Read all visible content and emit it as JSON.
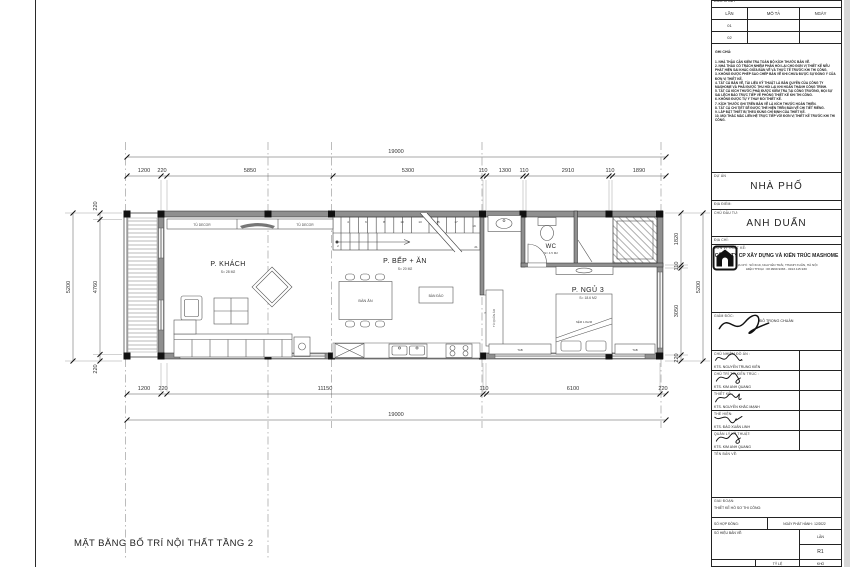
{
  "drawing_title": "MẶT BẰNG BỐ TRÍ NỘI THẤT TẦNG 2",
  "plan": {
    "rooms": {
      "living": {
        "name": "P. KHÁCH",
        "area": "S= 28 M2"
      },
      "kitchen": {
        "name": "P. BẾP + ĂN",
        "area": "S= 20 M2"
      },
      "wc": {
        "name": "WC",
        "area": "S= 4.5 M2"
      },
      "bedroom": {
        "name": "P. NGỦ 3",
        "area": "S= 18.6 M2"
      }
    },
    "furniture": {
      "tu_decor_left": "TỦ DECOR",
      "tu_decor_right": "TỦ DECOR",
      "ban_an": "BÀN ĂN",
      "ban_dao": "BÀN ĐẢO",
      "tu_quan_ao": "TỦ QUẦN ÁO",
      "bed": "NỆM 1.8x2M",
      "tab_left": "TAB",
      "tab_right": "TAB"
    },
    "stairs": {
      "numbers": [
        "2",
        "4",
        "6",
        "8",
        "10",
        "13",
        "15",
        "17",
        "19",
        "21"
      ]
    },
    "dims": {
      "top_overall": "19000",
      "top_segments": [
        "1200",
        "220",
        "5850",
        "5300",
        "110",
        "1300",
        "110",
        "2910",
        "110",
        "1890"
      ],
      "bottom_segments": [
        "1200",
        "220",
        "11150",
        "110",
        "6100",
        "220"
      ],
      "bottom_overall": "19000",
      "left_outer": "5200",
      "left_segments": [
        "220",
        "4760",
        "220"
      ],
      "right_segments": [
        "1820",
        "110",
        "3050",
        "220"
      ],
      "right_outer": "5200"
    }
  },
  "title_block": {
    "revision": {
      "header_label": "ĐIỀU CHỈNH",
      "col_lan": "LẦN",
      "col_mo_ta": "MÔ TẢ",
      "col_ngay": "NGÀY",
      "row1": "01",
      "row2": "02"
    },
    "notes_title": "GHI CHÚ:",
    "notes_text": "1. NHÀ THẦU CẦN KIỂM TRA TOÀN BỘ KÍCH THƯỚC BẢN VẼ.\n2. NHÀ THẦU CÓ TRÁCH NHIỆM PHẢN HỒI LẠI CHO ĐƠN VỊ THIẾT KẾ NẾU PHÁT HIỆN SAI KHÁC GIỮA BẢN VẼ VÀ THỰC TẾ TRƯỚC KHI THI CÔNG.\n3. KHÔNG ĐƯỢC PHÉP SAO CHÉP BẢN VẼ KHI CHƯA ĐƯỢC SỰ ĐỒNG Ý CỦA ĐƠN VỊ THIẾT KẾ.\n4. TẤT CẢ BẢN VẼ, TÀI LIỆU KỸ THUẬT LÀ BẢN QUYỀN CỦA CÔNG TY MASHOME VÀ PHẢI ĐƯỢC THU HỒI LẠI KHI HOÀN THÀNH CÔNG TRÌNH.\n5. TẤT CẢ KÍCH THƯỚC PHẢI ĐƯỢC KIỂM TRA TẠI CÔNG TRƯỜNG, MỌI SỰ SAI LỆCH BÁO TRỰC TIẾP VỀ PHÒNG THIẾT KẾ KHI THI CÔNG.\n6. KHÔNG ĐƯỢC TỰ Ý THAY ĐỔI THIẾT KẾ.\n7. KÍCH THƯỚC GHI TRÊN BẢN VẼ LÀ KÍCH THƯỚC HOÀN THIỆN.\n8. TẤT CẢ CHI TIẾT SẼ ĐƯỢC THỂ HIỆN TRÊN BẢN VẼ CHI TIẾT RIÊNG.\n9. LẮP ĐẶT THIẾT BỊ THEO ĐÚNG CHỈ ĐỊNH CỦA THIẾT KẾ.\n10. MỌI THẮC MẮC LIÊN HỆ TRỰC TIẾP VỚI ĐƠN VỊ THIẾT KẾ TRƯỚC KHI THI CÔNG.",
    "du_an_label": "DỰ ÁN",
    "du_an": "NHÀ PHỐ",
    "dia_diem_label": "ĐỊA ĐIỂM:",
    "chu_dau_tu_label": "CHỦ ĐẦU TƯ:",
    "chu_dau_tu": "ANH DUẤN",
    "dia_chi_label": "ĐỊA CHỈ:",
    "don_vi_label": "ĐƠN VỊ THIẾT KẾ:",
    "company": "CÔNG TY CP XÂY DỰNG VÀ KIẾN TRÚC MASHOME",
    "address_line1": "ĐỊA CHỈ : SỐ 6/19, NGUYỄN TRÃI, THANH XUÂN, HÀ NỘI",
    "address_line2": "ĐIỆN THOẠI : 08.9999.9383 - 0913.115.930",
    "giam_doc_label": "GIÁM ĐỐC:",
    "giam_doc": "ĐỖ TRỌNG CHUẨN",
    "staff": [
      {
        "label": "CHỦ NHIỆM ĐỒ ÁN :",
        "name": "KTS. NGUYỄN TRUNG KIÊN"
      },
      {
        "label": "CHỦ TRÌ T.K KIẾN TRÚC :",
        "name": "KTS. KIM ANH QUANG"
      },
      {
        "label": "THIẾT KẾ :",
        "name": "KTS. NGUYỄN KHẮC MẠNH"
      },
      {
        "label": "THỂ HIỆN:",
        "name": "KTS. ĐÀO XUÂN LINH"
      },
      {
        "label": "QUẢN LÝ KỸ THUẬT:",
        "name": "KTS. KIM ANH QUANG"
      }
    ],
    "ten_ban_ve_label": "TÊN BẢN VẼ:",
    "giai_doan_label": "GIAI ĐOẠN:",
    "giai_doan": "THIẾT KẾ HỒ SƠ THI CÔNG:",
    "so_hop_dong_label": "SỐ HỢP ĐỒNG:",
    "ngay_phat_hanh": "NGÀY PHÁT HÀNH : 12/2022",
    "so_hieu_label": "SỐ HIỆU BẢN VẼ:",
    "lan_label": "LẦN",
    "lan_value": "R1",
    "ty_le_label": "TỶ LỆ",
    "kho_label": "KHỔ"
  }
}
